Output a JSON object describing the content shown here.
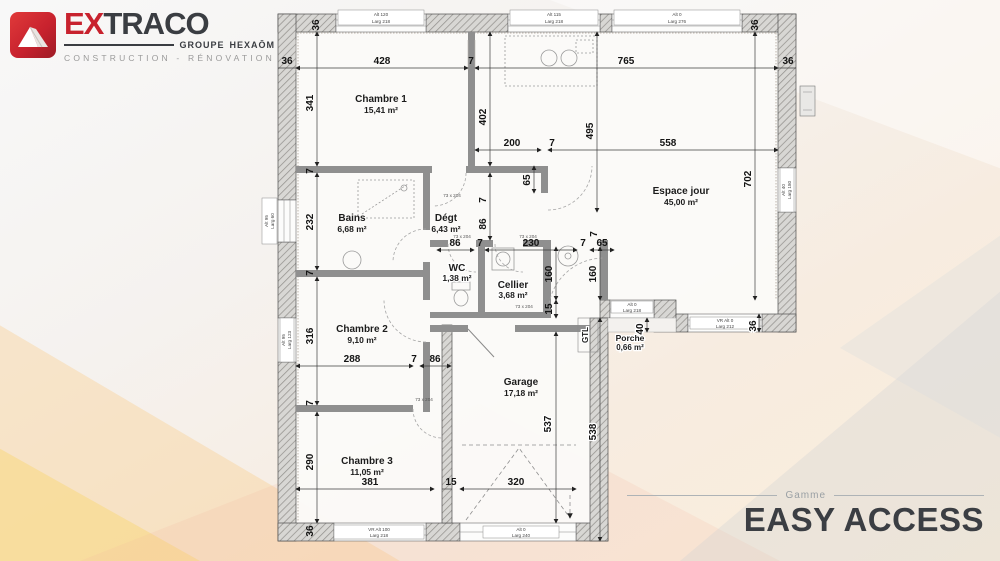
{
  "logo": {
    "brand_prefix": "EX",
    "brand_suffix": "TRACO",
    "group_label": "GROUPE",
    "group_name": "HEXAŌM",
    "tagline": "CONSTRUCTION - RÉNOVATION"
  },
  "gamme": {
    "label": "Gamme",
    "name": "EASY ACCESS"
  },
  "colors": {
    "brand_red": "#c8222e",
    "brand_dark": "#3a3d42",
    "wall_gray": "#8f8f8f"
  },
  "rooms": [
    {
      "name": "Chambre 1",
      "area": "15,41 m²"
    },
    {
      "name": "Espace jour",
      "area": "45,00 m²"
    },
    {
      "name": "Bains",
      "area": "6,68 m²"
    },
    {
      "name": "Dégt",
      "area": "6,43 m²"
    },
    {
      "name": "WC",
      "area": "1,38 m²"
    },
    {
      "name": "Cellier",
      "area": "3,68 m²"
    },
    {
      "name": "Chambre 2",
      "area": "9,10 m²"
    },
    {
      "name": "Garage",
      "area": "17,18 m²"
    },
    {
      "name": "Chambre 3",
      "area": "11,05 m²"
    },
    {
      "name": "Porche",
      "area": "0,66 m²"
    },
    {
      "name": "GTL",
      "area": ""
    }
  ],
  "dims": [
    "36",
    "428",
    "7",
    "765",
    "36",
    "36",
    "36",
    "341",
    "402",
    "495",
    "200",
    "7",
    "558",
    "702",
    "65",
    "7",
    "232",
    "7",
    "7",
    "86",
    "86",
    "7",
    "230",
    "7",
    "65",
    "7",
    "160",
    "160",
    "15",
    "316",
    "288",
    "7",
    "86",
    "7",
    "290",
    "381",
    "15",
    "320",
    "36",
    "537",
    "538",
    "40",
    "36"
  ],
  "door_labels": [
    "73 x 204",
    "73 x 204",
    "73 x 204",
    "73 x 204",
    "73 x 204"
  ],
  "window_labels": [
    {
      "l1": "Alt 120",
      "l2": "Larg 218"
    },
    {
      "l1": "Alt 115",
      "l2": "Larg 218"
    },
    {
      "l1": "Alt 0",
      "l2": "Larg 276"
    },
    {
      "l1": "VR Alt 100",
      "l2": "Larg 218"
    },
    {
      "l1": "VR Alt 0",
      "l2": "Larg 212"
    },
    {
      "l1": "Alt 0",
      "l2": "Larg 218"
    },
    {
      "l1": "Alt 0",
      "l2": "Larg 240"
    },
    {
      "l1": "Alt 95",
      "l2": "Larg 60"
    },
    {
      "l1": "Alt 95",
      "l2": "Larg 123"
    },
    {
      "l1": "Alt 40",
      "l2": "Larg 180"
    }
  ]
}
